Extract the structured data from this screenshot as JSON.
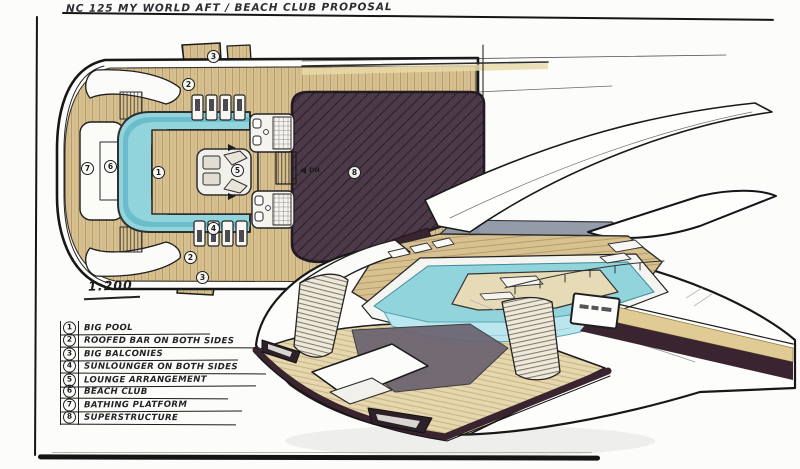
{
  "title": "NC 125 MY WORLD AFT / BEACH CLUB PROPOSAL",
  "scale": {
    "label": "1:200"
  },
  "plan_view": {
    "stair_label": "DN",
    "markers": [
      {
        "name": "marker-balcony-top",
        "label": "3"
      },
      {
        "name": "marker-roofed-bar-top",
        "label": "2"
      },
      {
        "name": "marker-bathing-platform",
        "label": "7"
      },
      {
        "name": "marker-beach-club",
        "label": "6"
      },
      {
        "name": "marker-big-pool",
        "label": "1"
      },
      {
        "name": "marker-lounge-arrangement",
        "label": "5"
      },
      {
        "name": "marker-sunloungers",
        "label": "4"
      },
      {
        "name": "marker-roofed-bar-bottom",
        "label": "2"
      },
      {
        "name": "marker-balcony-bottom",
        "label": "3"
      },
      {
        "name": "marker-superstructure",
        "label": "8"
      }
    ]
  },
  "legend": {
    "items": [
      {
        "num": "1",
        "label": "BIG POOL"
      },
      {
        "num": "2",
        "label": "ROOFED BAR ON BOTH SIDES"
      },
      {
        "num": "3",
        "label": "BIG BALCONIES"
      },
      {
        "num": "4",
        "label": "SUNLOUNGER ON BOTH SIDES"
      },
      {
        "num": "5",
        "label": "LOUNGE ARRANGEMENT"
      },
      {
        "num": "6",
        "label": "BEACH CLUB"
      },
      {
        "num": "7",
        "label": "BATHING PLATFORM"
      },
      {
        "num": "8",
        "label": "SUPERSTRUCTURE"
      }
    ]
  },
  "colors": {
    "paper": "#fcfcfa",
    "ink": "#1c1c1c",
    "deck": "#d8c190",
    "deck_light": "#e6d7ae",
    "pool": "#92d4dc",
    "pool_deep": "#5fb6c6",
    "pool_front": "#bce6ee",
    "superstructure": "#4c3a49",
    "trim": "#392430",
    "gold": "#dfcb93",
    "glass": "#8f97a6",
    "stair": "#efe9da"
  }
}
